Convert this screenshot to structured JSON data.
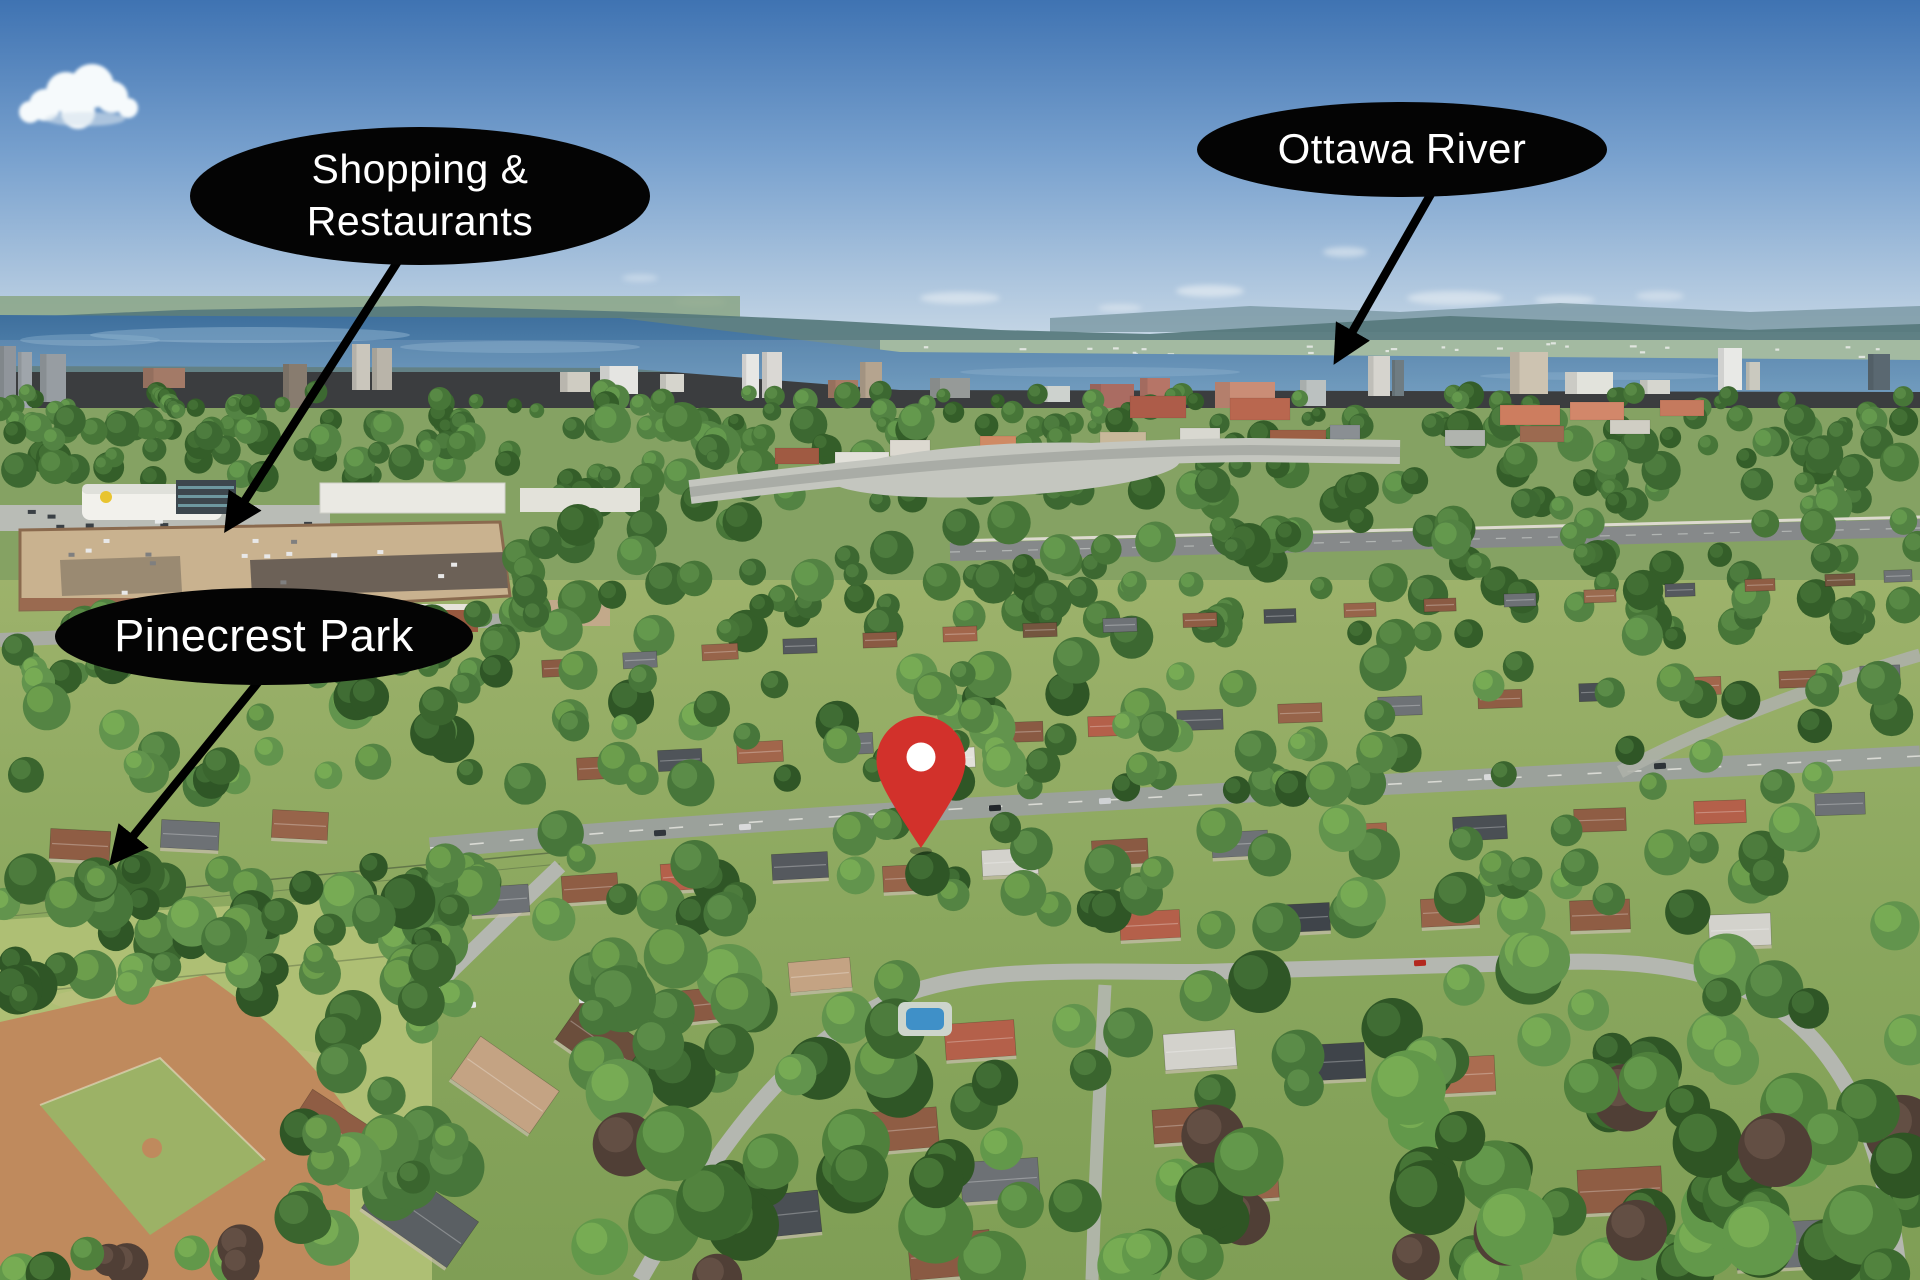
{
  "title": "Aerial neighbourhood photo with location callouts",
  "callouts": {
    "shopping": {
      "line1": "Shopping &",
      "line2": "Restaurants"
    },
    "river": {
      "label": "Ottawa River"
    },
    "park": {
      "label": "Pinecrest Park"
    }
  },
  "marker": {
    "label": "property-location-pin",
    "color": "#d2312b",
    "dot_color": "#ffffff"
  },
  "style": {
    "callout_bg": "#040404",
    "callout_text": "#ffffff",
    "arrow_color": "#000000"
  }
}
